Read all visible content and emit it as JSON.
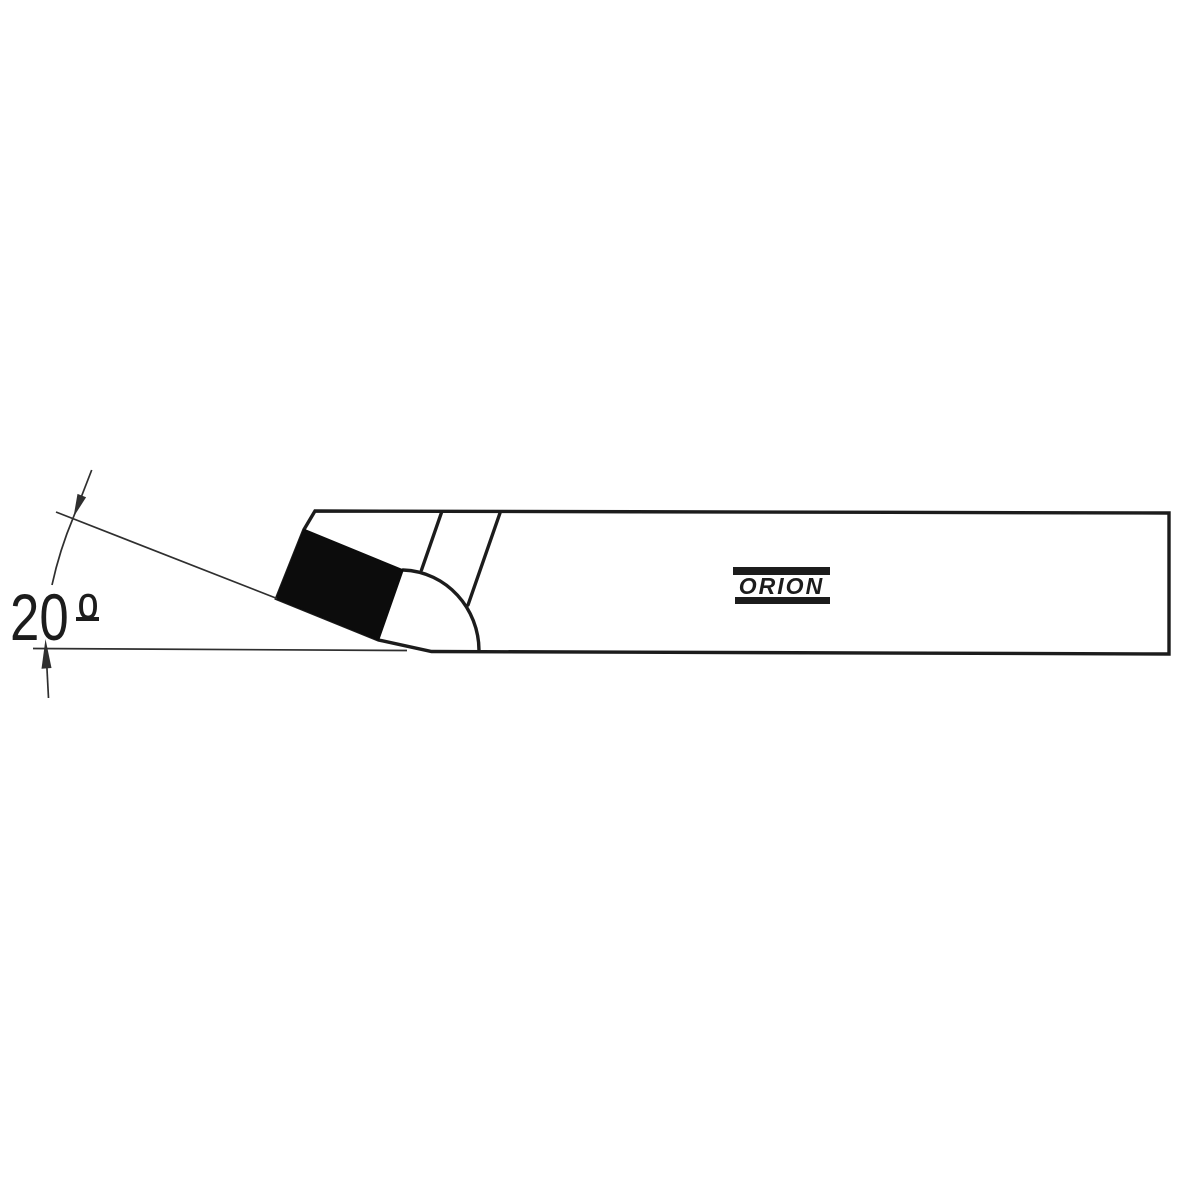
{
  "drawing": {
    "angle": {
      "value": "20",
      "symbol": "º",
      "label": "20º"
    },
    "brand_label": "ORION",
    "colors": {
      "line_color": "#1c1c1c",
      "thin_line_color": "#2f2f2f",
      "insert_fill": "#0c0c0c",
      "background": "#ffffff"
    }
  }
}
